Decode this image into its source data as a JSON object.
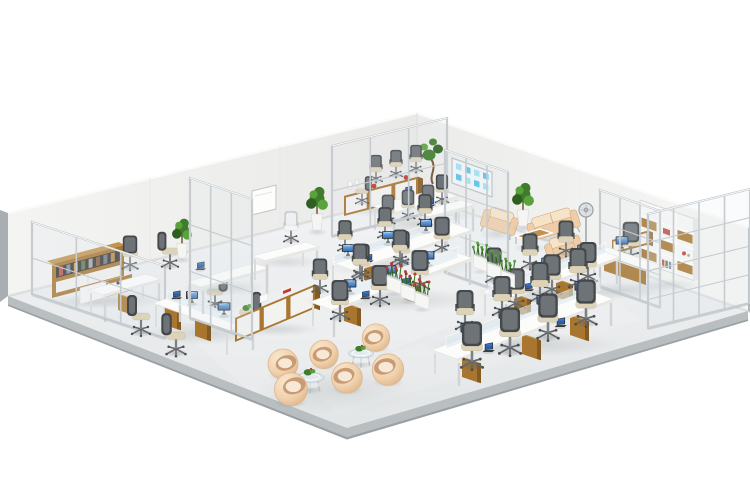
{
  "image": {
    "kind": "3d-render",
    "description": "Isometric 3D rendering of a modern open-plan office interior on a white background",
    "width_px": 750,
    "height_px": 500,
    "background": "#ffffff"
  },
  "palette": {
    "wall": "#f0f0ee",
    "wall_shade": "#e8e8e6",
    "floor_light": "#f2f3f4",
    "floor_dark": "#e2e5e6",
    "floor_edge": "#b9bec1",
    "floor_edge_line": "#9aa1a5",
    "wood": "#a9762f",
    "wood_light": "#c2924e",
    "wood_dark": "#845c22",
    "white_furniture": "#fcfcfb",
    "white_shade": "#e7e7e5",
    "chair_frame": "#44484b",
    "chair_mesh": "#6e7377",
    "seat": "#ddd3b8",
    "white_chair": "#eef0f1",
    "lounge": "#eecda8",
    "lounge_light": "#f6e3c8",
    "lounge_dark": "#d3a97f",
    "tub_inner": "#c99b74",
    "tub_cushion": "#f7e9d6",
    "green": "#3e7d2c",
    "green_dark": "#2e5f20",
    "green_light": "#5aa23c",
    "red": "#c03a30",
    "glass_frame": "#c7ccd0",
    "glass": "#dfeaf0",
    "screen_top": "#86c0ef",
    "screen_bottom": "#2a5fae",
    "notes_blue": "#4fc2e8",
    "notes_blue_light": "#9ddff2",
    "metal": "#9aa0a4",
    "chrome": "#b9bfc3"
  },
  "scene": {
    "areas": [
      {
        "id": "private-office-left",
        "label": "Private office (left)",
        "contents": [
          "glass partition wall",
          "low bookshelf with books",
          "executive desk with credenza",
          "task chair"
        ]
      },
      {
        "id": "meeting-room",
        "label": "Meeting room",
        "contents": [
          "white conference table with laptop",
          "7 task chairs",
          "wood sideboard with vases and red bowls",
          "bonsai tree",
          "glass wall with sticky-note board"
        ]
      },
      {
        "id": "reception-lounge",
        "label": "Reception lounge",
        "contents": [
          "beige loveseat",
          "2 beige armchairs",
          "wood coffee table",
          "floor plant",
          "pedestal fan"
        ]
      },
      {
        "id": "private-office-right",
        "label": "Private office (right)",
        "contents": [
          "glass partition walls",
          "bookshelf with wood doors",
          "executive desk with credenza",
          "task chair",
          "monitor"
        ]
      },
      {
        "id": "open-plan-area",
        "label": "Open-plan workstations",
        "contents": [
          "5 bench desk clusters",
          "30 task chairs",
          "glass desk screens",
          "16 monitors",
          "10 laptops",
          "storage cabinet row",
          "6 planter boxes"
        ]
      },
      {
        "id": "casual-lounge",
        "label": "Casual seating lounge",
        "contents": [
          "6 round beige tub chairs",
          "2 round glass coffee tables with plants"
        ]
      },
      {
        "id": "standalone-desks",
        "label": "Standalone desks",
        "contents": [
          "2 single desks with chairs",
          "corner desk by far wall",
          "wall whiteboard"
        ]
      }
    ],
    "furniture_inventory": {
      "workstation_bench_clusters": 5,
      "workstation_seats": 30,
      "task_chairs": 41,
      "white_guest_chairs": 1,
      "conference_tables": 1,
      "executive_desks": 2,
      "standalone_desks": 3,
      "tub_chairs": 6,
      "loveseats": 1,
      "lounge_armchairs": 2,
      "wood_coffee_tables": 1,
      "glass_coffee_tables": 2,
      "pedestal_fans": 1,
      "bookshelves": 2,
      "storage_cabinets": 4,
      "floor_plants": 3,
      "bonsai_trees": 1,
      "planter_boxes": 6,
      "glass_partition_walls": 6,
      "monitors": 16,
      "laptops": 10,
      "whiteboards": 1,
      "sticky_note_boards": 1,
      "vases": 2
    }
  }
}
